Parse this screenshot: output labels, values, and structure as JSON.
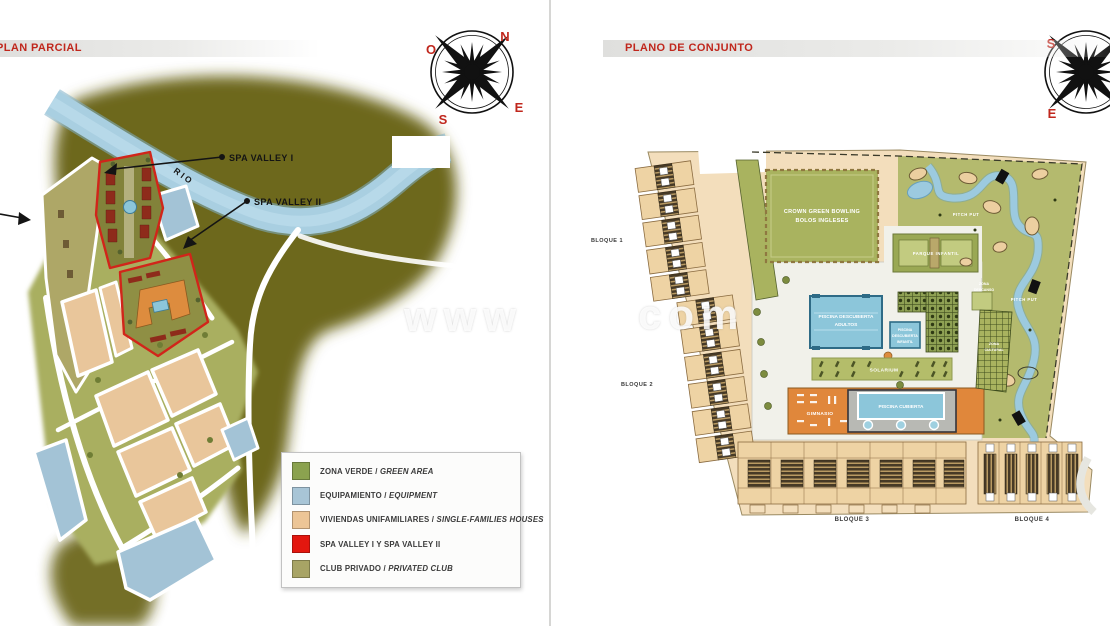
{
  "left": {
    "title": "PLAN PARCIAL",
    "river_label": "RIO",
    "callout_spa1": "SPA VALLEY I",
    "callout_spa2": "SPA VALLEY II",
    "compass": {
      "n": "N",
      "o": "O",
      "s": "S",
      "e": "E"
    },
    "legend": {
      "items": [
        {
          "name": "ZONA VERDE",
          "sep": " / ",
          "en": "GREEN AREA",
          "color": "#8ba24f"
        },
        {
          "name": "EQUIPAMIENTO",
          "sep": " / ",
          "en": "EQUIPMENT",
          "color": "#a8c5d6"
        },
        {
          "name": "VIVIENDAS UNIFAMILIARES",
          "sep": " / ",
          "en": "SINGLE-FAMILIES HOUSES",
          "color": "#ecc596"
        },
        {
          "name": "SPA VALLEY I Y SPA VALLEY II",
          "sep": "",
          "en": "",
          "color": "#e3170f"
        },
        {
          "name": "CLUB PRIVADO",
          "sep": " / ",
          "en": "PRIVATED CLUB",
          "color": "#a8a465"
        }
      ]
    }
  },
  "right": {
    "title": "PLANO DE CONJUNTO",
    "compass": {
      "s": "S",
      "e": "E"
    },
    "blocks": {
      "b1": "BLOQUE 1",
      "b2": "BLOQUE 2",
      "b3": "BLOQUE 3",
      "b4": "BLOQUE 4"
    },
    "facilities": {
      "bowling1": "CROWN GREEN BOWLING",
      "bowling2": "BOLOS INGLESES",
      "adult_pool1": "PISCINA DESCUBIERTA",
      "adult_pool2": "ADULTOS",
      "kids_pool1": "PISCINA",
      "kids_pool2": "DESCUBIERTA",
      "kids_pool3": "INFANTIL",
      "indoor_pool": "PISCINA CUBIERTA",
      "gym": "GIMNASIO",
      "solarium": "SOLARIUM",
      "playground": "PARQUE INFANTIL",
      "pitch_put_a": "PITCH PUT",
      "pitch_put_b": "PITCH PUT",
      "rest1": "ZONA",
      "rest2": "DESCANSO",
      "cultural1": "ZONA",
      "cultural2": "CULTURAL"
    }
  },
  "watermark": {
    "left": "www",
    "right": "com"
  }
}
